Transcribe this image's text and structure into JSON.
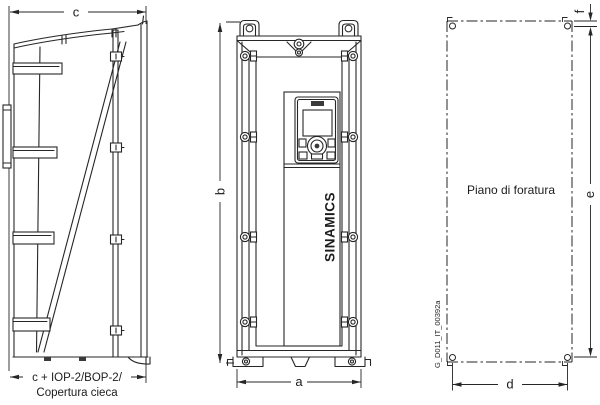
{
  "diagram": {
    "side_view": {
      "dim_depth": "c",
      "dim_depth_total": "c + IOP-2/BOP-2/",
      "dim_depth_caption": "Copertura cieca"
    },
    "front_view": {
      "dim_height": "b",
      "dim_width": "a",
      "brand": "SINAMICS"
    },
    "drill_plan": {
      "title": "Piano di foratura",
      "dim_width": "d",
      "dim_height": "e",
      "dim_top_offset": "f",
      "doc_id": "G_D011_IT_00392a"
    },
    "colors": {
      "line": "#262626",
      "background": "#ffffff"
    }
  }
}
